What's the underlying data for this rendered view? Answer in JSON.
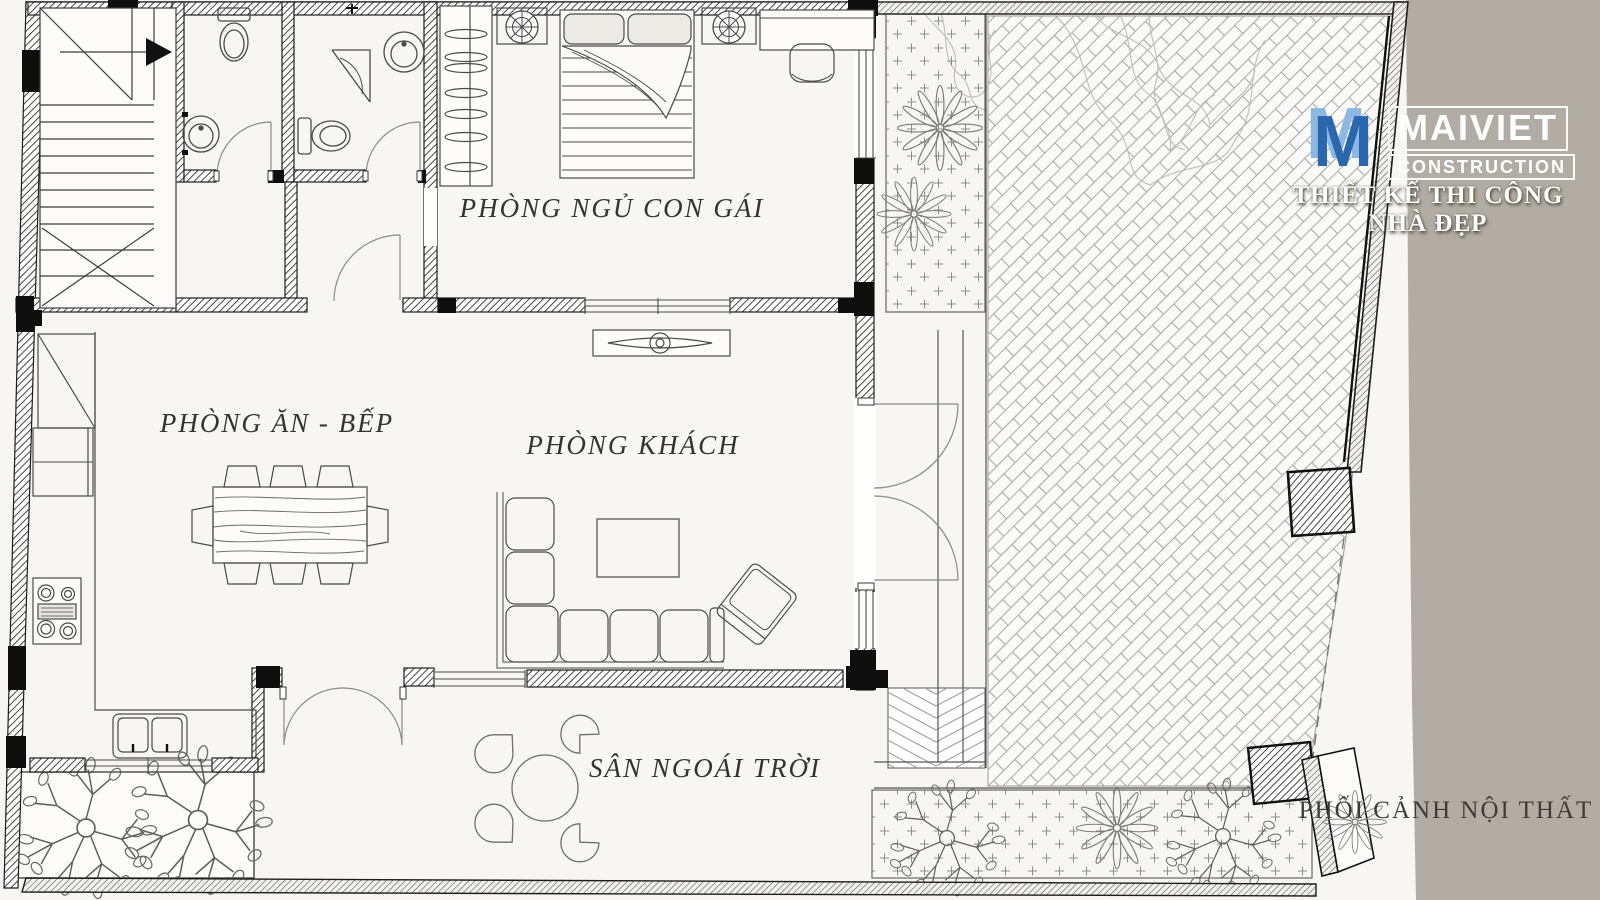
{
  "page": {
    "paper_color": "#f7f6f3",
    "margin_color": "#b2ada4",
    "line_color": "#3a3a3a"
  },
  "plan": {
    "rooms": [
      {
        "id": "bedroom",
        "label": "PHÒNG NGỦ CON GÁI"
      },
      {
        "id": "kitchen_dining",
        "label": "PHÒNG ĂN - BẾP"
      },
      {
        "id": "living",
        "label": "PHÒNG KHÁCH"
      },
      {
        "id": "yard",
        "label": "SÂN NGOÁI TRỜI"
      }
    ],
    "caption": "PHỐI CẢNH NỘI THẤT"
  },
  "branding": {
    "logo_mark": "M",
    "logo_name": "MAIVIET",
    "logo_sub": "CONSTRUCTION",
    "tagline": "THIẾT KẾ THI CÔNG NHÀ ĐẸP",
    "logo_blue_light": "#8db8e4",
    "logo_blue_dark": "#2a67ad"
  }
}
